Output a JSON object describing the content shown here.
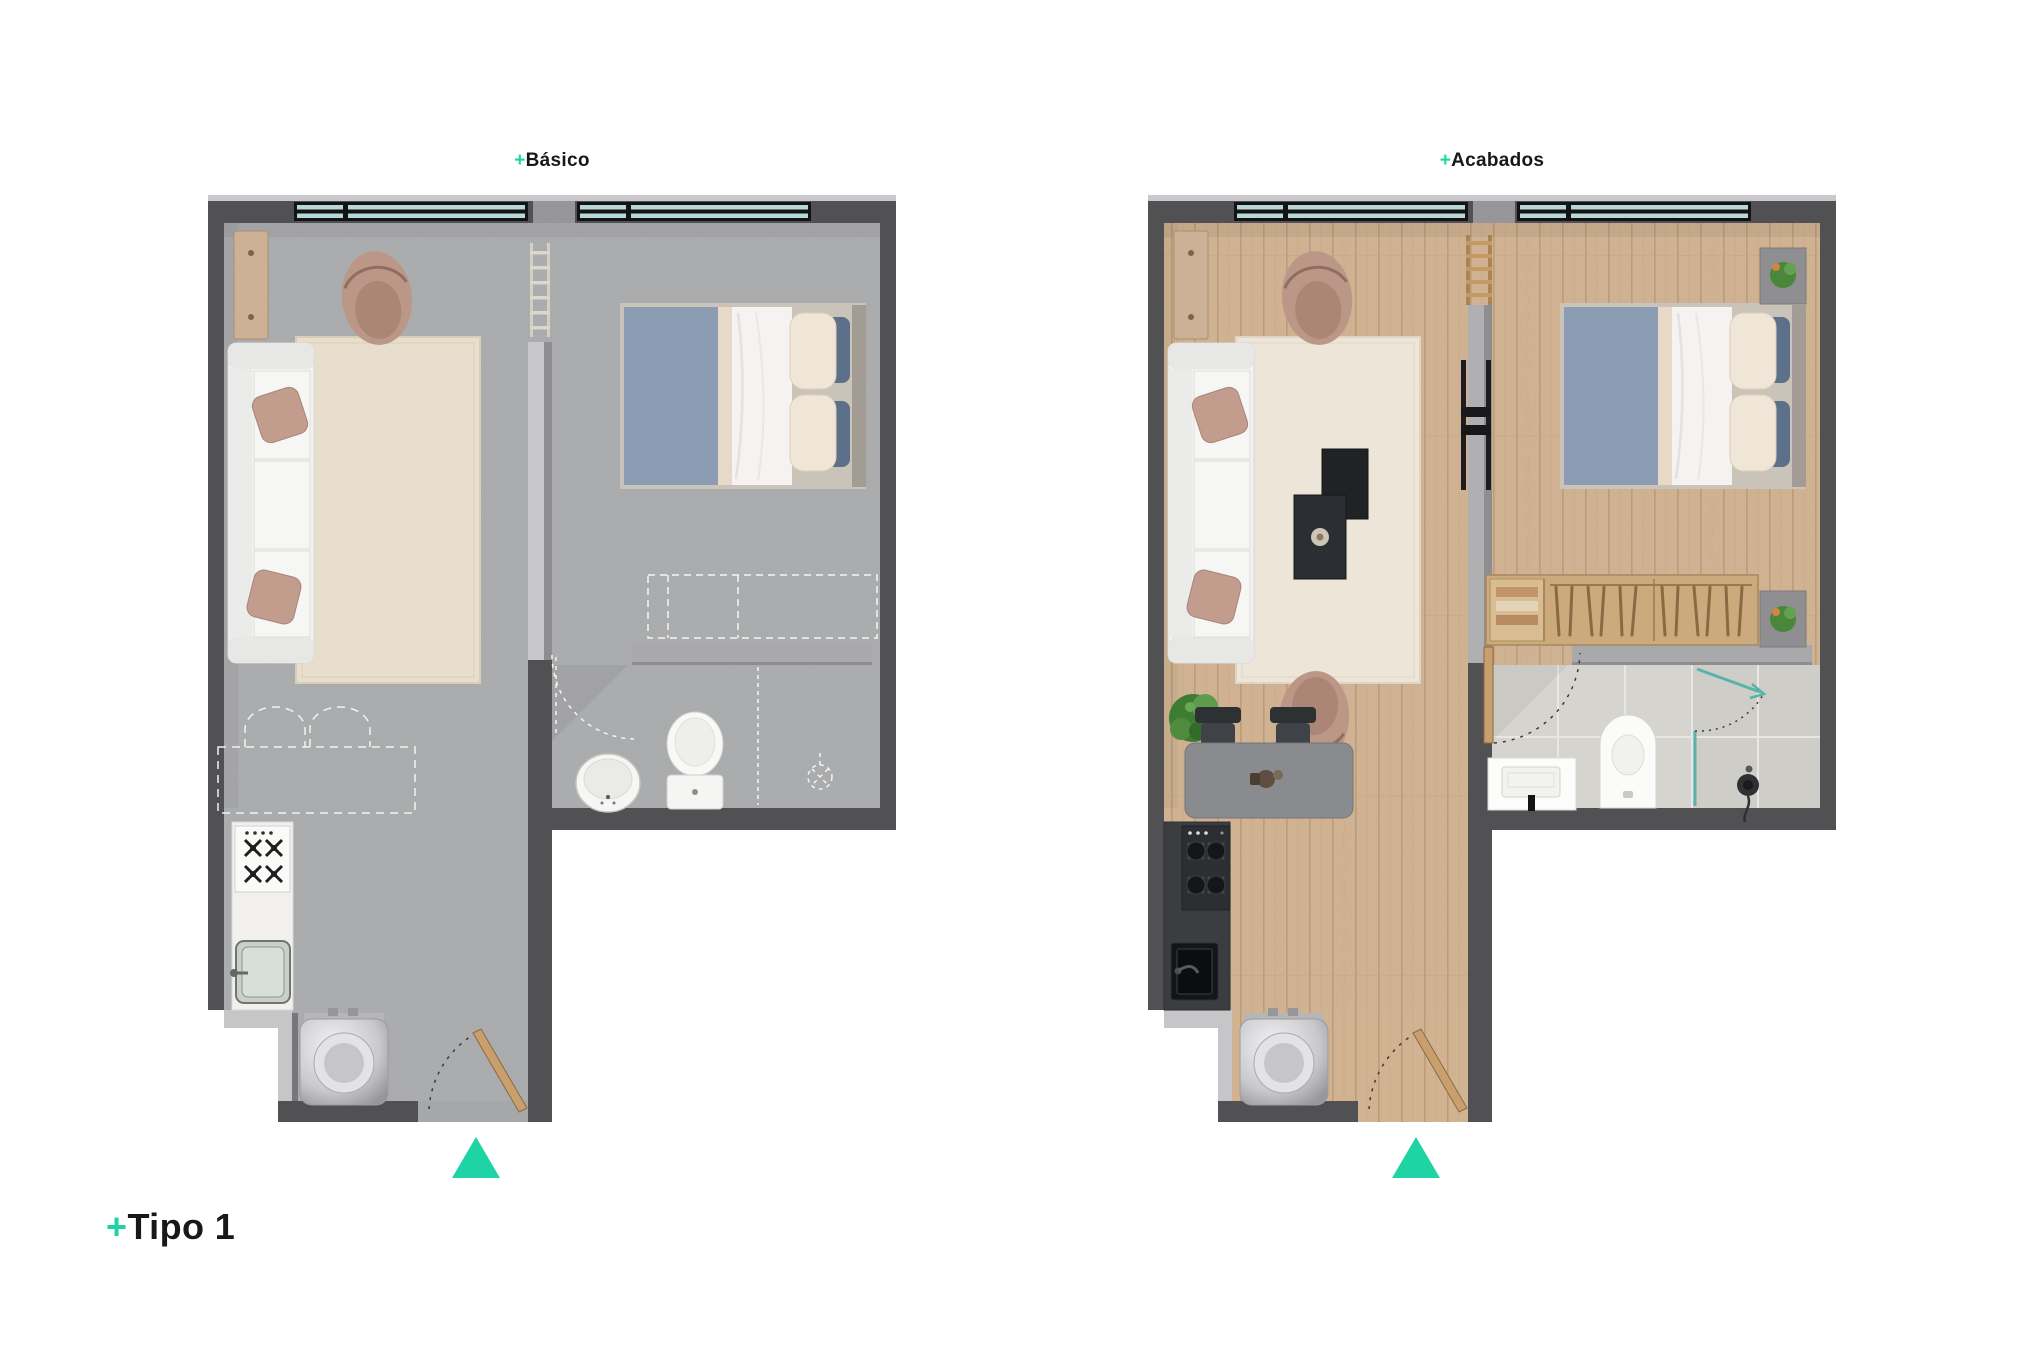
{
  "page": {
    "background_color": "#ffffff"
  },
  "accent": {
    "teal": "#1ed3a4",
    "text_color": "#17181a"
  },
  "labels": {
    "plan_left": {
      "prefix": "+",
      "text": "Básico"
    },
    "plan_right": {
      "prefix": "+",
      "text": "Acabados"
    },
    "type": {
      "prefix": "+",
      "text": "Tipo 1"
    }
  },
  "plans": [
    {
      "id": "basico",
      "title": "Básico",
      "floor_finish": "bare concrete",
      "windows": 2,
      "direction_marker": "teal triangle pointing up at entry",
      "rooms": [
        {
          "name": "living",
          "furniture": [
            "sofa with two tan cushions",
            "area rug",
            "tan lounge chair",
            "wall shelf",
            "ladder shelf"
          ]
        },
        {
          "name": "bedroom",
          "furniture": [
            "double bed with blue duvet, white sheet and two cream pillows",
            "dashed closet outline (not included)"
          ]
        },
        {
          "name": "bathroom",
          "fixtures": [
            "pedestal sink",
            "toilet",
            "dashed shower outline (not included)",
            "door swing arc"
          ]
        },
        {
          "name": "kitchen",
          "fixtures": [
            "white counter",
            "4-burner cooktop",
            "single sink",
            "dashed island outline (not included)",
            "washer"
          ]
        },
        {
          "name": "entry",
          "fixtures": [
            "entry door with swing arc"
          ]
        }
      ]
    },
    {
      "id": "acabados",
      "title": "Acabados",
      "floor_finish": "wood plank",
      "windows": 2,
      "direction_marker": "teal triangle pointing up at entry",
      "rooms": [
        {
          "name": "living",
          "furniture": [
            "sofa with two tan cushions",
            "area rug",
            "two tan lounge chairs",
            "nesting coffee tables",
            "plant",
            "tv panel",
            "wood ladder shelf",
            "wall shelf"
          ]
        },
        {
          "name": "bedroom",
          "furniture": [
            "double bed with blue duvet, white sheet and two cream pillows",
            "two nightstands with plants",
            "open wardrobe with hangers and folded clothes"
          ]
        },
        {
          "name": "bathroom",
          "floor": "ceramic tile",
          "fixtures": [
            "vanity sink with black faucet",
            "toilet",
            "glass shower with teal screen and handheld head",
            "door with swing arc"
          ]
        },
        {
          "name": "kitchen",
          "fixtures": [
            "dark counter",
            "4-burner cooktop",
            "black sink",
            "island counter with two stools",
            "washer"
          ]
        },
        {
          "name": "entry",
          "fixtures": [
            "entry door with swing arc"
          ]
        }
      ]
    }
  ],
  "colors": {
    "wall_dark": "#515154",
    "wall_light": "#c6c6c8",
    "concrete_floor": "#abacae",
    "wood_floor": "#d1b392",
    "tile_floor": "#d6d4cf",
    "window_glass": "#b7d7d9",
    "window_frame": "#131313",
    "rug_basico": "#e8decd",
    "rug_acabados": "#ece5d8",
    "sofa": "#f2f2f1",
    "cushion_tan": "#c29c8d",
    "bed_blanket": "#8c9db3",
    "bed_pillow": "#efe6d7",
    "wood_furniture": "#cbaa7e",
    "shower_glass_teal": "#5ab3ab",
    "triangle_teal": "#1ed3a4"
  }
}
